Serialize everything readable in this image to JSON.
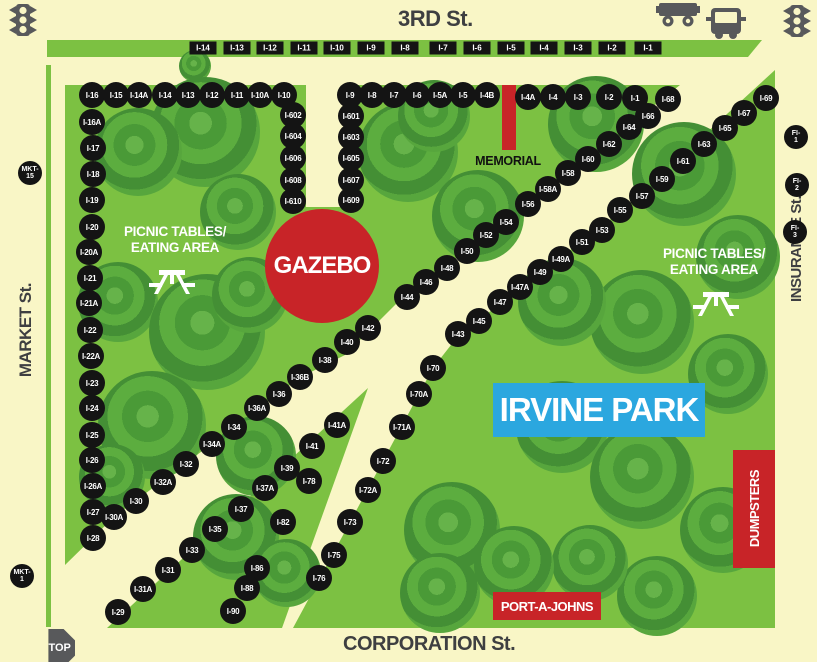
{
  "streets": {
    "top": "3RD St.",
    "bottom": "CORPORATION St.",
    "left": "MARKET St.",
    "right": "INSURANCE St."
  },
  "park": {
    "name": "IRVINE PARK"
  },
  "features": {
    "gazebo": "GAZEBO",
    "memorial": "MEMORIAL",
    "dumpsters": "DUMPSTERS",
    "port_a_johns": "PORT-A-JOHNS",
    "picnic_line1": "PICNIC TABLES/",
    "picnic_line2": "EATING AREA",
    "stop_sign": "STOP"
  },
  "colors": {
    "background_street": "#F9F6C6",
    "park_green": "#7CC142",
    "tree_green_dark": "#3E8A33",
    "booth_black": "#141414",
    "feature_red": "#C82428",
    "banner_blue": "#2BA7DF",
    "icon_gray": "#58595B"
  },
  "booths": {
    "street_row": [
      {
        "label": "I-14",
        "x": 203,
        "y": 48
      },
      {
        "label": "I-13",
        "x": 237,
        "y": 48
      },
      {
        "label": "I-12",
        "x": 270,
        "y": 48
      },
      {
        "label": "I-11",
        "x": 304,
        "y": 48
      },
      {
        "label": "I-10",
        "x": 337,
        "y": 48
      },
      {
        "label": "I-9",
        "x": 371,
        "y": 48
      },
      {
        "label": "I-8",
        "x": 405,
        "y": 48
      },
      {
        "label": "I-7",
        "x": 443,
        "y": 48
      },
      {
        "label": "I-6",
        "x": 477,
        "y": 48
      },
      {
        "label": "I-5",
        "x": 511,
        "y": 48
      },
      {
        "label": "I-4",
        "x": 544,
        "y": 48
      },
      {
        "label": "I-3",
        "x": 578,
        "y": 48
      },
      {
        "label": "I-2",
        "x": 612,
        "y": 48
      },
      {
        "label": "I-1",
        "x": 648,
        "y": 48
      }
    ],
    "park": [
      {
        "label": "I-16",
        "x": 92,
        "y": 95
      },
      {
        "label": "I-15",
        "x": 116,
        "y": 95
      },
      {
        "label": "I-14A",
        "x": 139,
        "y": 95
      },
      {
        "label": "I-14",
        "x": 165,
        "y": 95
      },
      {
        "label": "I-13",
        "x": 188,
        "y": 95
      },
      {
        "label": "I-12",
        "x": 212,
        "y": 95
      },
      {
        "label": "I-11",
        "x": 237,
        "y": 95
      },
      {
        "label": "I-10A",
        "x": 260,
        "y": 95
      },
      {
        "label": "I-10",
        "x": 284,
        "y": 95
      },
      {
        "label": "I-9",
        "x": 350,
        "y": 95
      },
      {
        "label": "I-8",
        "x": 372,
        "y": 95
      },
      {
        "label": "I-7",
        "x": 394,
        "y": 95
      },
      {
        "label": "I-6",
        "x": 417,
        "y": 95
      },
      {
        "label": "I-5A",
        "x": 440,
        "y": 95
      },
      {
        "label": "I-5",
        "x": 463,
        "y": 95
      },
      {
        "label": "I-4B",
        "x": 487,
        "y": 95
      },
      {
        "label": "I-4A",
        "x": 528,
        "y": 97
      },
      {
        "label": "I-4",
        "x": 553,
        "y": 97
      },
      {
        "label": "I-3",
        "x": 578,
        "y": 97
      },
      {
        "label": "I-2",
        "x": 609,
        "y": 97
      },
      {
        "label": "I-1",
        "x": 635,
        "y": 98
      },
      {
        "label": "I-68",
        "x": 668,
        "y": 99
      },
      {
        "label": "I-602",
        "x": 293,
        "y": 115
      },
      {
        "label": "I-604",
        "x": 293,
        "y": 136
      },
      {
        "label": "I-606",
        "x": 293,
        "y": 158
      },
      {
        "label": "I-608",
        "x": 293,
        "y": 180
      },
      {
        "label": "I-610",
        "x": 293,
        "y": 201
      },
      {
        "label": "I-601",
        "x": 351,
        "y": 116
      },
      {
        "label": "I-603",
        "x": 351,
        "y": 137
      },
      {
        "label": "I-605",
        "x": 351,
        "y": 158
      },
      {
        "label": "I-607",
        "x": 351,
        "y": 180
      },
      {
        "label": "I-609",
        "x": 351,
        "y": 200
      },
      {
        "label": "I-16A",
        "x": 92,
        "y": 122
      },
      {
        "label": "I-17",
        "x": 93,
        "y": 148
      },
      {
        "label": "I-18",
        "x": 93,
        "y": 174
      },
      {
        "label": "I-19",
        "x": 92,
        "y": 200
      },
      {
        "label": "I-20",
        "x": 92,
        "y": 227
      },
      {
        "label": "I-20A",
        "x": 89,
        "y": 252
      },
      {
        "label": "I-21",
        "x": 90,
        "y": 278
      },
      {
        "label": "I-21A",
        "x": 89,
        "y": 303
      },
      {
        "label": "I-22",
        "x": 90,
        "y": 330
      },
      {
        "label": "I-22A",
        "x": 91,
        "y": 356
      },
      {
        "label": "I-23",
        "x": 92,
        "y": 383
      },
      {
        "label": "I-24",
        "x": 92,
        "y": 408
      },
      {
        "label": "I-25",
        "x": 92,
        "y": 435
      },
      {
        "label": "I-26",
        "x": 92,
        "y": 460
      },
      {
        "label": "I-26A",
        "x": 93,
        "y": 486
      },
      {
        "label": "I-27",
        "x": 93,
        "y": 512
      },
      {
        "label": "I-28",
        "x": 93,
        "y": 538
      },
      {
        "label": "I-66",
        "x": 648,
        "y": 116
      },
      {
        "label": "I-64",
        "x": 629,
        "y": 127
      },
      {
        "label": "I-62",
        "x": 609,
        "y": 144
      },
      {
        "label": "I-60",
        "x": 588,
        "y": 159
      },
      {
        "label": "I-58",
        "x": 568,
        "y": 173
      },
      {
        "label": "I-58A",
        "x": 548,
        "y": 189
      },
      {
        "label": "I-56",
        "x": 528,
        "y": 204
      },
      {
        "label": "I-54",
        "x": 506,
        "y": 222
      },
      {
        "label": "I-52",
        "x": 486,
        "y": 235
      },
      {
        "label": "I-50",
        "x": 467,
        "y": 251
      },
      {
        "label": "I-48",
        "x": 447,
        "y": 268
      },
      {
        "label": "I-46",
        "x": 426,
        "y": 282
      },
      {
        "label": "I-44",
        "x": 407,
        "y": 297
      },
      {
        "label": "I-42",
        "x": 368,
        "y": 328
      },
      {
        "label": "I-40",
        "x": 347,
        "y": 342
      },
      {
        "label": "I-38",
        "x": 325,
        "y": 360
      },
      {
        "label": "I-36B",
        "x": 300,
        "y": 377
      },
      {
        "label": "I-36",
        "x": 279,
        "y": 394
      },
      {
        "label": "I-36A",
        "x": 257,
        "y": 408
      },
      {
        "label": "I-34",
        "x": 234,
        "y": 427
      },
      {
        "label": "I-34A",
        "x": 212,
        "y": 444
      },
      {
        "label": "I-32",
        "x": 186,
        "y": 464
      },
      {
        "label": "I-32A",
        "x": 163,
        "y": 482
      },
      {
        "label": "I-30",
        "x": 136,
        "y": 501
      },
      {
        "label": "I-30A",
        "x": 114,
        "y": 517
      },
      {
        "label": "I-69",
        "x": 766,
        "y": 98
      },
      {
        "label": "I-67",
        "x": 744,
        "y": 113
      },
      {
        "label": "I-65",
        "x": 725,
        "y": 128
      },
      {
        "label": "I-63",
        "x": 704,
        "y": 144
      },
      {
        "label": "I-61",
        "x": 683,
        "y": 161
      },
      {
        "label": "I-59",
        "x": 662,
        "y": 179
      },
      {
        "label": "I-57",
        "x": 642,
        "y": 196
      },
      {
        "label": "I-55",
        "x": 620,
        "y": 210
      },
      {
        "label": "I-53",
        "x": 602,
        "y": 230
      },
      {
        "label": "I-51",
        "x": 582,
        "y": 242
      },
      {
        "label": "I-49A",
        "x": 561,
        "y": 259
      },
      {
        "label": "I-49",
        "x": 540,
        "y": 272
      },
      {
        "label": "I-47A",
        "x": 520,
        "y": 287
      },
      {
        "label": "I-47",
        "x": 500,
        "y": 302
      },
      {
        "label": "I-45",
        "x": 479,
        "y": 321
      },
      {
        "label": "I-43",
        "x": 458,
        "y": 334
      },
      {
        "label": "I-70",
        "x": 433,
        "y": 368
      },
      {
        "label": "I-70A",
        "x": 419,
        "y": 394
      },
      {
        "label": "I-71A",
        "x": 402,
        "y": 427
      },
      {
        "label": "I-72",
        "x": 383,
        "y": 461
      },
      {
        "label": "I-72A",
        "x": 368,
        "y": 490
      },
      {
        "label": "I-73",
        "x": 350,
        "y": 522
      },
      {
        "label": "I-75",
        "x": 334,
        "y": 555
      },
      {
        "label": "I-76",
        "x": 319,
        "y": 578
      },
      {
        "label": "I-41A",
        "x": 337,
        "y": 425
      },
      {
        "label": "I-41",
        "x": 312,
        "y": 446
      },
      {
        "label": "I-39",
        "x": 287,
        "y": 468
      },
      {
        "label": "I-37A",
        "x": 265,
        "y": 488
      },
      {
        "label": "I-37",
        "x": 241,
        "y": 509
      },
      {
        "label": "I-35",
        "x": 215,
        "y": 529
      },
      {
        "label": "I-33",
        "x": 192,
        "y": 550
      },
      {
        "label": "I-31",
        "x": 168,
        "y": 570
      },
      {
        "label": "I-31A",
        "x": 143,
        "y": 589
      },
      {
        "label": "I-29",
        "x": 118,
        "y": 612
      },
      {
        "label": "I-78",
        "x": 309,
        "y": 481
      },
      {
        "label": "I-82",
        "x": 283,
        "y": 522
      },
      {
        "label": "I-86",
        "x": 257,
        "y": 568
      },
      {
        "label": "I-88",
        "x": 247,
        "y": 588
      },
      {
        "label": "I-90",
        "x": 233,
        "y": 611
      }
    ],
    "special": [
      {
        "line1": "MKT-",
        "line2": "15",
        "x": 30,
        "y": 173
      },
      {
        "line1": "MKT-",
        "line2": "1",
        "x": 22,
        "y": 576
      },
      {
        "line1": "FI-",
        "line2": "1",
        "x": 796,
        "y": 137
      },
      {
        "line1": "FI-",
        "line2": "2",
        "x": 797,
        "y": 185
      },
      {
        "line1": "FI-",
        "line2": "3",
        "x": 795,
        "y": 232
      }
    ]
  }
}
